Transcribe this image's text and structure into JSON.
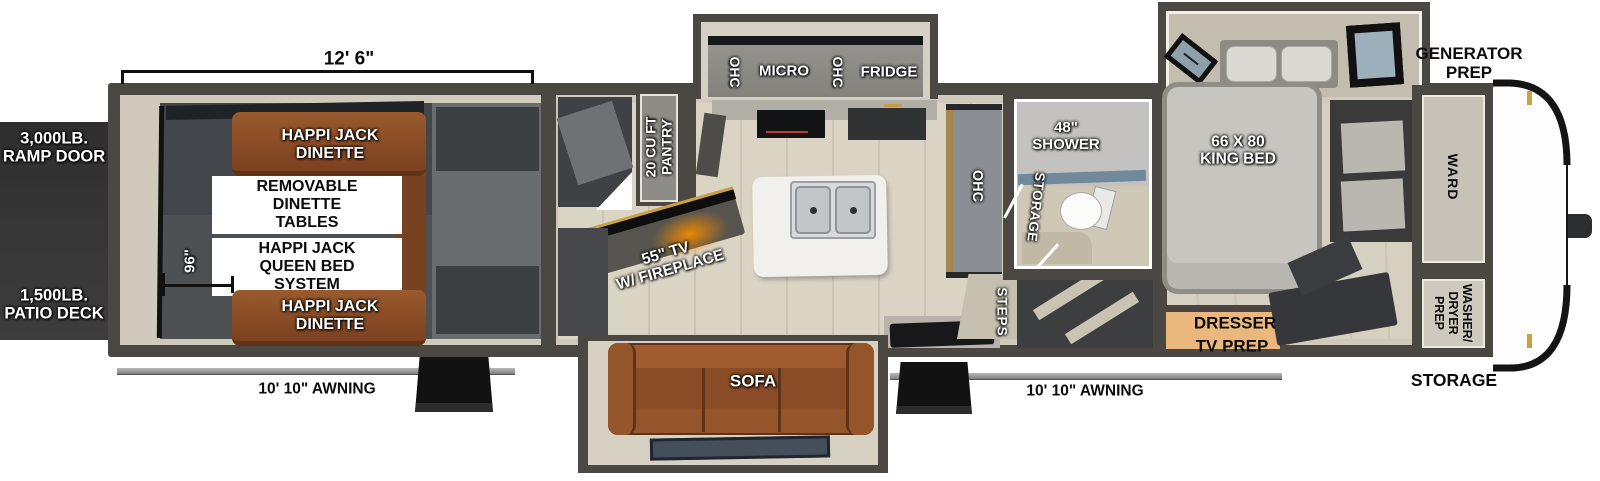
{
  "palette": {
    "wall": "#4b4843",
    "trim": "#cfcabb",
    "main_floor": "#dad4c4",
    "garage_floor": "#4d5154",
    "slide_interior": "#d2cdbf",
    "sofa_brown": "#8a4c26",
    "dinette_brown": "#8a4c26",
    "dresser_tan": "#eab87c",
    "bed_gray": "#c7c5bf",
    "cabinet_gray": "#8f8d88",
    "shower_glass": "#72889b",
    "fireplace_glow": "#f08a00",
    "exterior_block": "#353535",
    "cap_white": "#fdfdfd",
    "accent_gold": "#c9a23f"
  },
  "exterior": {
    "ramp_door": "3,000LB.\nRAMP DOOR",
    "patio_deck": "1,500LB.\nPATIO DECK",
    "awning_left": "10' 10\" AWNING",
    "awning_right": "10' 10\" AWNING",
    "generator_prep": "GENERATOR\nPREP",
    "front_storage": "STORAGE"
  },
  "dimensions": {
    "garage_width": "12' 6\"",
    "garage_depth": "96\""
  },
  "garage": {
    "dinette_front": "HAPPI JACK\nDINETTE",
    "removable_tables": "REMOVABLE\nDINETTE\nTABLES",
    "queen_bed": "HAPPI JACK\nQUEEN BED\nSYSTEM",
    "dinette_rear": "HAPPI JACK\nDINETTE"
  },
  "kitchen": {
    "ohc_left": "OHC",
    "micro": "MICRO",
    "ohc_center": "OHC",
    "fridge": "FRIDGE",
    "pantry": "20 CU FT\nPANTRY",
    "tv_fireplace": "55\" TV\nW/ FIREPLACE",
    "ohc_wall": "OHC"
  },
  "living": {
    "sofa": "SOFA",
    "steps": "STEPS"
  },
  "bathroom": {
    "shower": "48\"\nSHOWER",
    "storage": "STORAGE"
  },
  "bedroom": {
    "king_bed": "66 X 80\nKING BED",
    "dresser": "DRESSER",
    "tv_prep": "TV PREP",
    "ward": "WARD",
    "washer_dryer": "WASHER/\nDRYER\nPREP"
  }
}
